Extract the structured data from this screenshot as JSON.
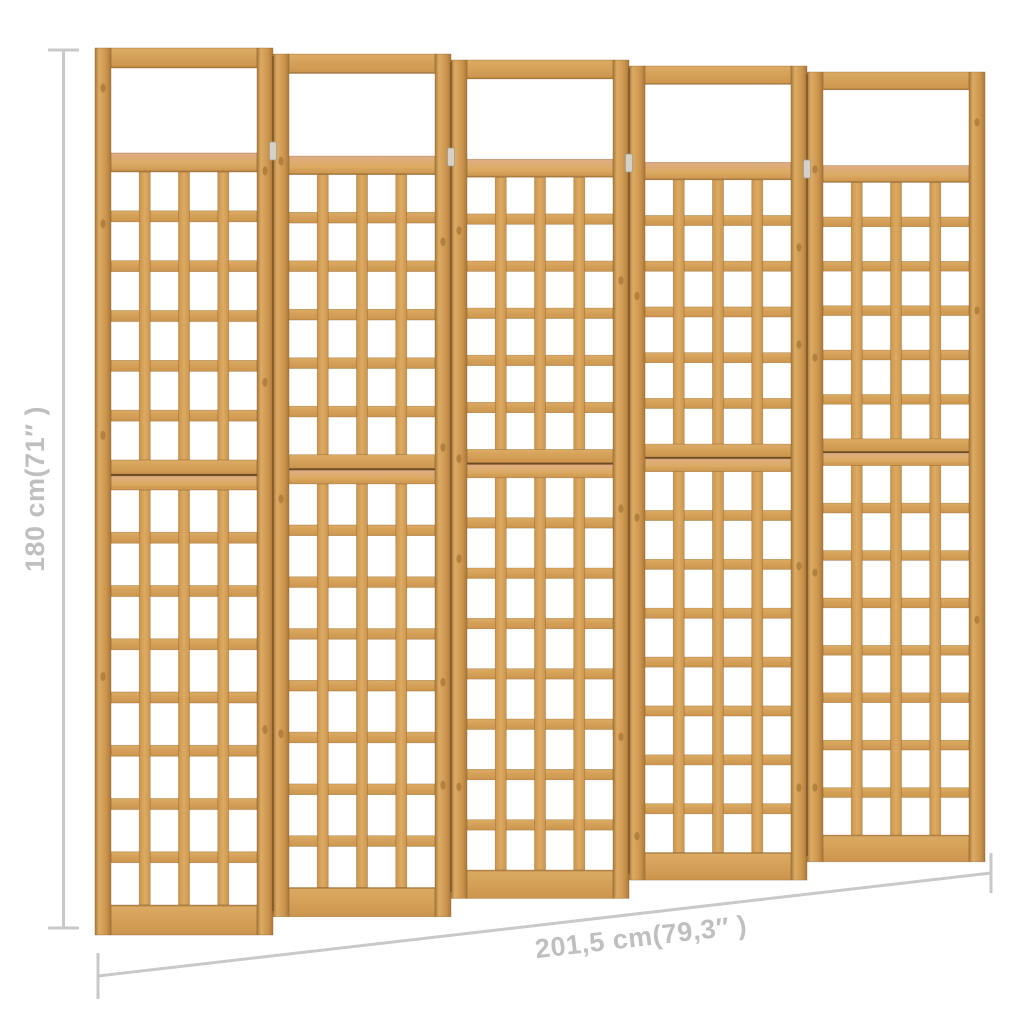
{
  "subject": "wooden trellis room divider, 5 hinged lattice panels",
  "trellis": {
    "panel_count": 5,
    "lattice_columns_per_panel": 4,
    "upper_lattice_rows": 6,
    "lower_lattice_rows": 8
  },
  "dimensions": {
    "height_label": "180 cm(71″ )",
    "width_label": "201,5 cm(79,3″ )"
  },
  "colors": {
    "background": "#ffffff",
    "wood_light": "#dcab63",
    "wood_mid": "#cc954e",
    "wood_dark": "#aa783a",
    "wood_edge": "#8a5f2c",
    "wood_salmon": "#dfad85",
    "seam": "#6e4b22",
    "hinge": "#d6d0c6",
    "dimension_line": "#c9c9c9",
    "dimension_text": "#bfbfbf"
  }
}
